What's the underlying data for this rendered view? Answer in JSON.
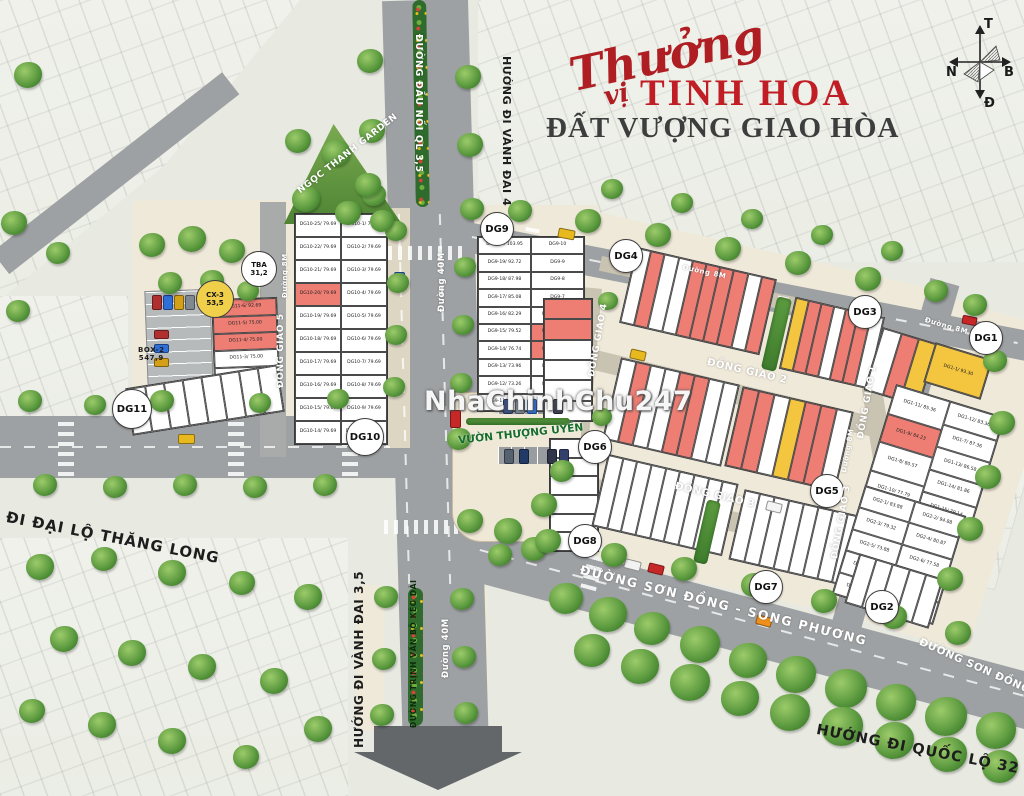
{
  "title": {
    "script_top": "Thưởng",
    "script_bottom": "vị",
    "main": "TINH HOA",
    "subtitle": "ĐẤT VƯỢNG GIAO HÒA"
  },
  "compass": {
    "top": "T",
    "left": "N",
    "right": "B",
    "bottom": "Đ"
  },
  "watermark": "NhaChinhChu247",
  "roads": {
    "dau_noi_ql35": "ĐƯỜNG ĐẦU NỐI QL 3,5",
    "huong_di_vanh_dai_4": "HƯỚNG ĐI VÀNH ĐAI 4",
    "duong_40m": "Đường 40M",
    "huong_di_vanh_dai_35": "HƯỚNG ĐI VÀNH ĐAI 3,5",
    "trinh_van_bo": "ĐƯỜNG TRỊNH VĂN BÔ KÉO DÀI",
    "di_dai_lo_thang_long": "ĐI ĐẠI LỘ THĂNG LONG",
    "huong_di_quoc_lo_32": "HƯỚNG ĐI QUỐC LỘ 32",
    "son_dong_song_phuong": "ĐƯỜNG SƠN ĐỒNG - SONG PHƯƠNG",
    "son_dong_song_2": "ĐƯỜNG SƠN ĐỒNG - SONG",
    "duong_8m": "Đường 8M"
  },
  "streets": {
    "dong_giao_1": "ĐỒNG GIAO 1",
    "dong_giao_2": "ĐỒNG GIAO 2",
    "dong_giao_3": "ĐỒNG GIAO 3",
    "dong_giao_4": "ĐỒNG GIAO 4",
    "dong_giao_5": "ĐỒNG GIAO 5"
  },
  "landmarks": {
    "garden": "NGỌC THANH GARDEN",
    "vuon_thuong_uyen": "VƯỜN THƯỢNG UYỂN",
    "tba": {
      "name": "TBA",
      "area": "31,2"
    },
    "cx3": {
      "name": "CX-3",
      "area": "53,5"
    },
    "box2": {
      "name": "BOX-2",
      "area": "547,9"
    }
  },
  "badges": {
    "dg1": "DG1",
    "dg2": "DG2",
    "dg3": "DG3",
    "dg4": "DG4",
    "dg5": "DG5",
    "dg6": "DG6",
    "dg7": "DG7",
    "dg8": "DG8",
    "dg9": "DG9",
    "dg10": "DG10",
    "dg11": "DG11"
  },
  "blocks": {
    "dg10": {
      "left": [
        "DG10-25/ 79.69",
        "DG10-22/ 79.69",
        "DG10-21/ 79.69",
        {
          "label": "DG10-20/ 79.69",
          "color": "r"
        },
        "DG10-19/ 79.69",
        "DG10-18/ 79.69",
        "DG10-17/ 79.69",
        "DG10-16/ 79.69",
        "DG10-15/ 79.69",
        "DG10-14/ 79.69"
      ],
      "right": [
        "DG10-1/ 79.69",
        "DG10-2/ 79.69",
        "DG10-3/ 79.69",
        "DG10-4/ 79.69",
        "DG10-5/ 79.69",
        "DG10-6/ 79.69",
        "DG10-7/ 79.69",
        "DG10-8/ 79.69",
        "DG10-9/ 79.69",
        "DG10-11/ 93.30"
      ]
    },
    "dg9": {
      "left": [
        "DG9-20/ 103.95",
        "DG9-19/ 92.72",
        "DG9-18/ 87.98",
        "DG9-17/ 85.08",
        "DG9-16/ 82.29",
        "DG9-15/ 79.52",
        "DG9-14/ 76.74",
        "DG9-13/ 73.96",
        "DG9-12/ 73.26",
        "DG9-11/ 79.62"
      ],
      "right": [
        "DG9-10",
        "DG9-9",
        "DG9-8",
        "DG9-7",
        "DG9-6/ 93.93",
        {
          "label": "DG9-5/ 84.22",
          "color": "r"
        },
        {
          "label": "DG9-4/ 84.09",
          "color": "r"
        },
        "DG9-3/ 78.48",
        "DG9-2/ 75.30",
        "DG9-1/ 74.20"
      ]
    },
    "dg11": {
      "rows": [
        {
          "label": "DG11-6/ 92.69",
          "color": "r"
        },
        {
          "label": "DG11-5/ 75.00",
          "color": "r"
        },
        {
          "label": "DG11-4/ 75.00",
          "color": "r"
        },
        "DG11-3/ 75.00",
        "DG11-2/ 75.00",
        "DG11-1/ 75.00"
      ]
    },
    "dg1": {
      "big": "DG1-1/ 93.30",
      "col1": [
        "DG1-11/ 85.36",
        {
          "label": "DG1-9/ 84.23",
          "color": "r"
        },
        "DG1-8/ 80.57",
        "DG1-10/ 77.79"
      ],
      "col2": [
        "DG1-12/ 83.36",
        "DG1-7/ 87.36",
        "DG1-13/ 86.58",
        "DG1-14/ 81.86",
        "DG1-15/ 79.14"
      ]
    },
    "dg2": {
      "col1": [
        "DG2-1/ 83.88",
        "DG2-3/ 79.32",
        "DG2-5/ 73.88",
        "DG2-7/ 73.28",
        "DG2-9/ 73.88"
      ],
      "col2": [
        "DG2-2/ 94.88",
        "DG2-4/ 80.87",
        "DG2-6/ 77.58",
        "DG2-8/ 73.88",
        "DG2-10/ 73.14"
      ]
    }
  },
  "strips": {
    "a1": [
      {
        "c": "w"
      },
      {
        "c": "r"
      },
      {
        "c": "w"
      },
      {
        "c": "w"
      },
      {
        "c": "r"
      },
      {
        "c": "r"
      },
      {
        "c": "r"
      },
      {
        "c": "r"
      },
      {
        "c": "w"
      },
      {
        "c": "r"
      }
    ],
    "a2": [
      {
        "c": "y"
      },
      {
        "c": "r"
      },
      {
        "c": "r"
      },
      {
        "c": "w"
      },
      {
        "c": "r"
      },
      {
        "c": "r"
      },
      {
        "c": "w"
      }
    ],
    "b1": [
      {
        "c": "w"
      },
      {
        "c": "r"
      },
      {
        "c": "w"
      },
      {
        "c": "w"
      },
      {
        "c": "r"
      },
      {
        "c": "r"
      },
      {
        "c": "w"
      },
      {
        "c": "w"
      }
    ],
    "b2": [
      {
        "c": "r"
      },
      {
        "c": "r"
      },
      {
        "c": "w"
      },
      {
        "c": "y"
      },
      {
        "c": "r"
      },
      {
        "c": "r"
      },
      {
        "c": "w"
      }
    ],
    "c1": [
      {
        "c": "w"
      },
      {
        "c": "w"
      },
      {
        "c": "w"
      },
      {
        "c": "w"
      },
      {
        "c": "w"
      },
      {
        "c": "w"
      },
      {
        "c": "w"
      },
      {
        "c": "w"
      },
      {
        "c": "w"
      }
    ],
    "c2": [
      {
        "c": "w"
      },
      {
        "c": "w"
      },
      {
        "c": "w"
      },
      {
        "c": "w"
      },
      {
        "c": "w"
      },
      {
        "c": "w"
      },
      {
        "c": "w"
      },
      {
        "c": "w"
      }
    ],
    "l1": [
      {
        "c": "r"
      },
      {
        "c": "r"
      },
      {
        "c": "w"
      },
      {
        "c": "w"
      },
      {
        "c": "w"
      },
      {
        "c": "w"
      }
    ],
    "l2": [
      {
        "c": "w"
      },
      {
        "c": "w"
      },
      {
        "c": "w"
      },
      {
        "c": "w"
      },
      {
        "c": "w"
      },
      {
        "c": "w"
      }
    ],
    "dg11_fan": [
      {
        "c": "w"
      },
      {
        "c": "w"
      },
      {
        "c": "w"
      },
      {
        "c": "w"
      },
      {
        "c": "w"
      },
      {
        "c": "w"
      },
      {
        "c": "w"
      },
      {
        "c": "w"
      }
    ],
    "dg1_left": [
      {
        "c": "w"
      },
      {
        "c": "r"
      },
      {
        "c": "y"
      }
    ],
    "dg2_fan": [
      {
        "c": "w"
      },
      {
        "c": "w"
      },
      {
        "c": "w"
      },
      {
        "c": "w"
      },
      {
        "c": "w"
      }
    ]
  }
}
